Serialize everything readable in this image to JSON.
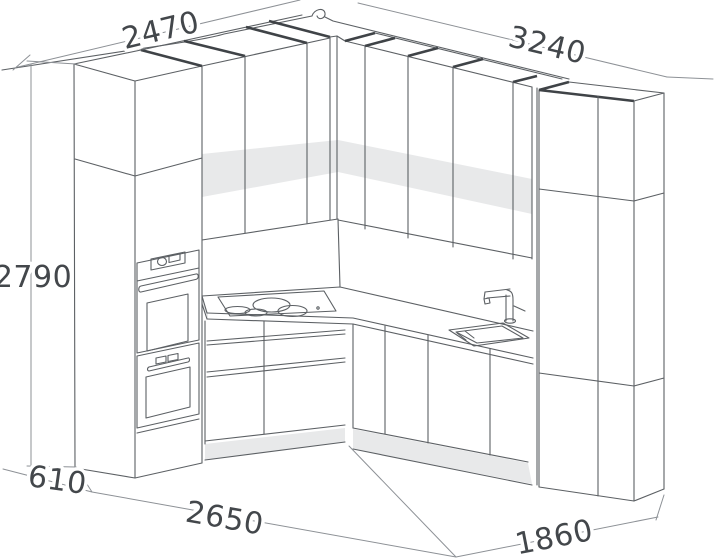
{
  "diagram": {
    "title": "kitchen-3d-dimension-drawing",
    "dimensions": {
      "left_wall_width": {
        "value": "2470",
        "unit_hint": "mm"
      },
      "right_wall_width": {
        "value": "3240",
        "unit_hint": "mm"
      },
      "cabinet_height": {
        "value": "2790",
        "unit_hint": "mm"
      },
      "tall_unit_depth": {
        "value": "610",
        "unit_hint": "mm"
      },
      "left_run_length": {
        "value": "2650",
        "unit_hint": "mm"
      },
      "right_run_length": {
        "value": "1860",
        "unit_hint": "mm"
      }
    },
    "colors": {
      "background": "#ffffff",
      "line": "#5c6064",
      "edge_accent": "#3f4347",
      "dimension_line": "#8d9196",
      "label_text": "#43474b",
      "shade": "#e8e9ea"
    },
    "features": [
      "tall-cabinet-column-with-double-oven",
      "wall-cabinets-left-run",
      "wall-cabinets-right-run",
      "induction-cooktop-4-zones",
      "undermount-sink-with-mixer-tap",
      "tall-cabinet-column-right",
      "toe-kick-recess"
    ]
  }
}
